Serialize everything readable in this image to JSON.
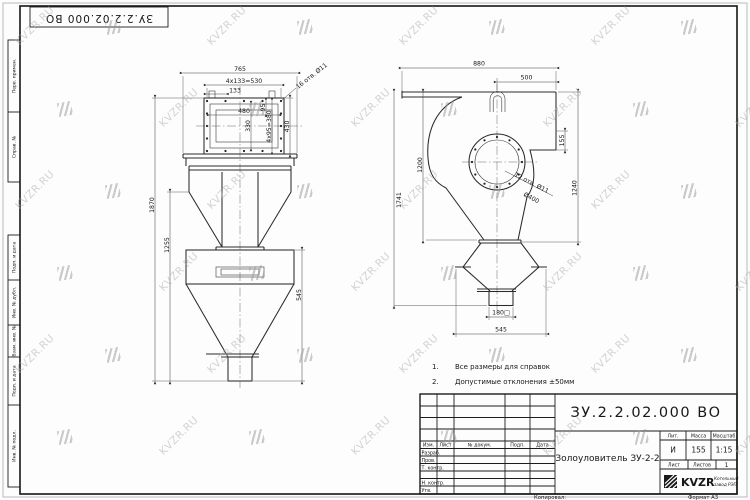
{
  "watermark": {
    "text": "KVZR.RU"
  },
  "top_stamp": {
    "doc_number": "ЗУ.2.2.02.000 ВО"
  },
  "margin_column": {
    "cells": [
      "Перв. примен.",
      "Справ. №",
      "Подп. и дата",
      "Инв. № дубл.",
      "Взам. инв. №",
      "Подп. и дата",
      "Инв. № подл."
    ]
  },
  "front_view": {
    "dims": {
      "total_width": "765",
      "bolt_row_top": "4x133=530",
      "bolt_pitch_top": "133",
      "holes_note": "16 отв. Ø11",
      "opening_width": "480",
      "opening_height": "330",
      "bolt_pitch_side": "95",
      "bolt_row_side": "4x95=380",
      "flange_height": "430",
      "total_height": "1870",
      "lower_height": "1255",
      "hopper_height": "545"
    }
  },
  "side_view": {
    "dims": {
      "total_width": "880",
      "outlet_offset": "500",
      "flange_drop": "155",
      "casing_height": "1200",
      "mid_height": "1741",
      "right_height": "1240",
      "holes_note": "12 отв. Ø11",
      "flange_dia": "Ø400",
      "outlet_square": "180□",
      "hopper_width": "545"
    }
  },
  "notes": {
    "n1": "1.",
    "t1": "Все размеры для справок",
    "n2": "2.",
    "t2": "Допустимые отклонения ±50мм"
  },
  "title_block": {
    "doc_number": "ЗУ.2.2.02.000 ВО",
    "product_title": "Золоуловитель ЗУ-2-2",
    "col_izm": "Изм.",
    "col_list": "Лист",
    "col_doc": "№ докум.",
    "col_podp": "Подп.",
    "col_data": "Дата",
    "row_razrab": "Разраб.",
    "row_prov": "Пров.",
    "row_tkontr": "Т. контр.",
    "row_nkontr": "Н. контр.",
    "row_utv": "Утв.",
    "lit_label": "Лит.",
    "lit_value": "И",
    "mass_label": "Масса",
    "mass_value": "155",
    "scale_label": "Масштаб",
    "scale_value": "1:15",
    "sheet_label": "Лист",
    "sheets_label": "Листов",
    "sheets_value": "1",
    "logo_text": "KVZR",
    "logo_sub1": "Котельный",
    "logo_sub2": "завод РЭП",
    "copied": "Копировал:",
    "format": "Формат А3"
  }
}
